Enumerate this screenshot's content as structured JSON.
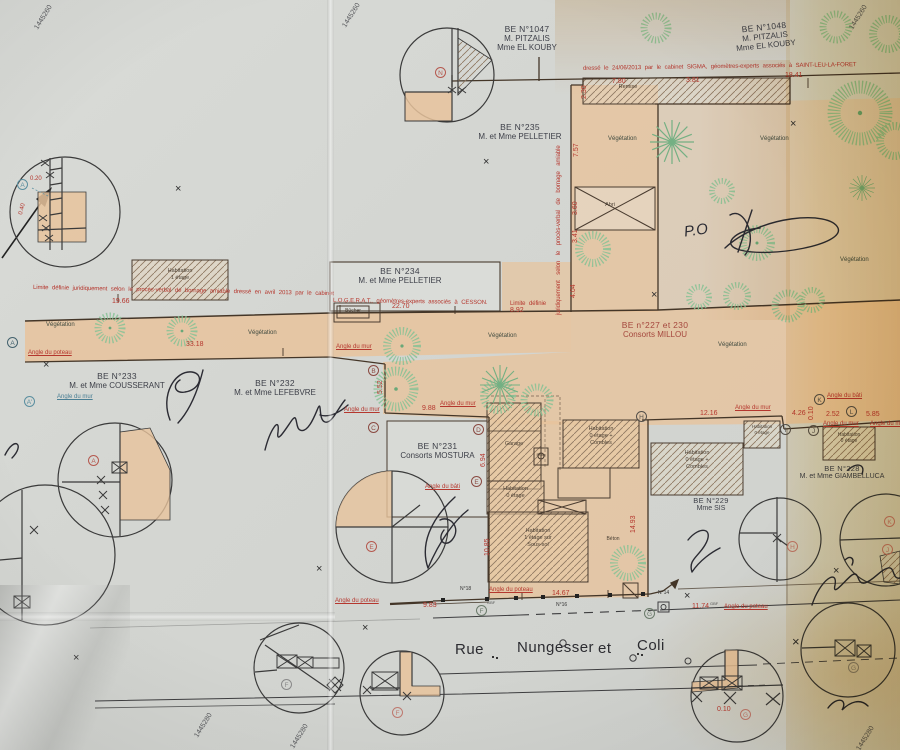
{
  "margin_labels": {
    "top": "1445260",
    "bottom": "1445280"
  },
  "street": {
    "words": [
      "Rue",
      "Nungesser",
      "et",
      "Coli"
    ]
  },
  "parcels": [
    {
      "id": "BE N°1047",
      "l1": "M. PITZALIS",
      "l2": "Mme EL KOUBY"
    },
    {
      "id": "BE N°1048",
      "l1": "M. PITZALIS",
      "l2": "Mme EL KOUBY"
    },
    {
      "id": "BE N°235",
      "l1": "M. et Mme PELLETIER"
    },
    {
      "id": "BE N°234",
      "l1": "M. et Mme PELLETIER"
    },
    {
      "id": "BE n°227 et 230",
      "l1": "Consorts MILLOU"
    },
    {
      "id": "BE N°233",
      "l1": "M. et Mme COUSSERANT"
    },
    {
      "id": "BE N°232",
      "l1": "M. et Mme LEFEBVRE"
    },
    {
      "id": "BE N°231",
      "l1": "Consorts MOSTURA"
    },
    {
      "id": "BE N°229",
      "l1": "Mme SIS"
    },
    {
      "id": "BE N°228",
      "l1": "M. et Mme GIAMBELLUCA"
    }
  ],
  "notes": {
    "sigma": "dressé le 24/06/2013 par le cabinet SIGMA, géomètres-experts associés à SAINT-LEU-LA-FORET",
    "limite_a": "Limite définie juridiquement selon le procès-verbal de bornage amiable dressé en avril 2013 par le cabinet",
    "limite_b": "L.O.G.E.R.A.T., géomètres-experts associés à CESSON.",
    "limite_c": "Limite définie",
    "limite_vert": "juridiquement selon le procès-verbal de bornage amiable"
  },
  "labels": {
    "vegetation": "Végétation",
    "remise": "Remise",
    "abri": "Abri",
    "bucher": "Bûcher",
    "garage": "Garage",
    "puits": "Puits",
    "beton": "Béton",
    "hab_1": "Habitation\n1 étage",
    "hab_0c": "Habitation\n0 étage +\nCombles",
    "hab_0": "Habitation\n0 étage",
    "hab_1ss": "Habitation\n1 étage sur\nSous-sol",
    "angle_mur": "Angle du mur",
    "angle_poteau": "Angle du poteau",
    "angle_bati": "Angle du bâti",
    "gbf": "GBF",
    "n18": "N°18",
    "n16": "N°16",
    "n14": "N°14",
    "po": "P.O"
  },
  "measurements": {
    "values": [
      "33.18",
      "19.66",
      "22.70",
      "8.92",
      "4.04",
      "2.30",
      "7.80",
      "3.81",
      "18.41",
      "7.57",
      "3.60",
      "3.41",
      "5.52",
      "9.88",
      "12.16",
      "4.26",
      "0.10",
      "2.52",
      "5.85",
      "10.85",
      "14.93",
      "6.94",
      "14.67",
      "9.83",
      "11.74",
      "0.10",
      "0.20",
      "0.40"
    ]
  },
  "points": {
    "n": "N",
    "a": "A",
    "a_prime": "A'",
    "b": "B",
    "c": "C",
    "d": "D",
    "e": "E",
    "f": "F",
    "g": "G",
    "h": "H",
    "i": "I",
    "j": "J",
    "k": "K",
    "l": "L"
  },
  "colors": {
    "paper": "#d5d7d3",
    "tan": "#e7c39c",
    "red": "#b5372e",
    "line": "#4a3c30",
    "tree": "#86c295",
    "warm": "#eccf92",
    "ink": "#2b2b33"
  }
}
